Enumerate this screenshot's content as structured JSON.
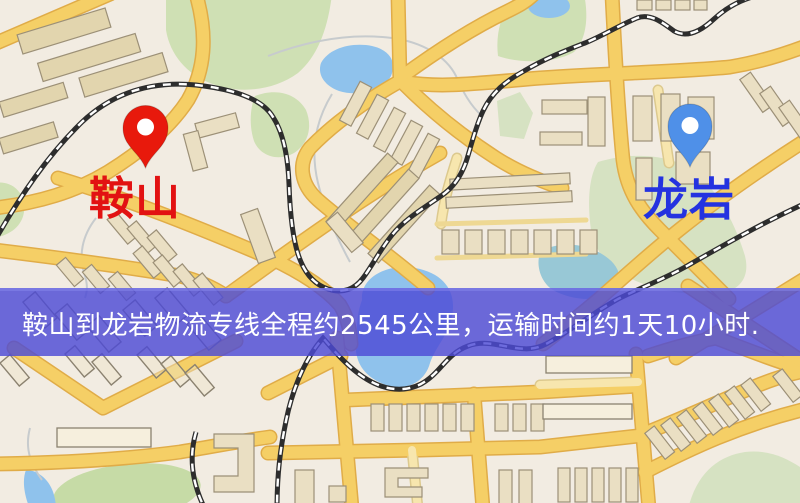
{
  "map": {
    "origin": {
      "label": "鞍山",
      "label_color": "#e21212",
      "pin_color": "#e8190c"
    },
    "destination": {
      "label": "龙岩",
      "label_color": "#2433e0",
      "pin_color": "#4f90e8"
    }
  },
  "banner": {
    "text": "鞍山到龙岩物流专线全程约2545公里，运输时间约1天10小时.",
    "text_color": "#ffffff",
    "bg_rgba": "rgba(77,75,214,0.82)"
  },
  "palette": {
    "background": "#f2ece2",
    "road": "#f5cf66",
    "water": "#8fc2ec",
    "green": "#cfe0b4",
    "building": "#eadfc3",
    "railway": "#2d2d2d"
  }
}
